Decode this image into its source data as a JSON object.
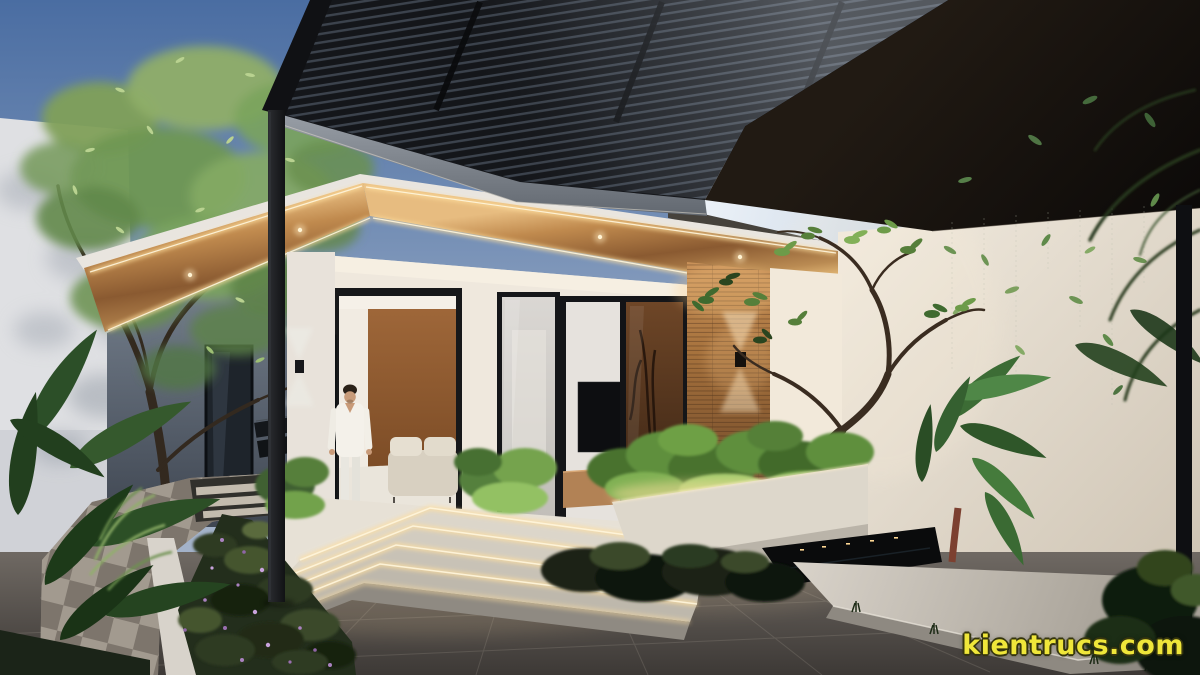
{
  "watermark": {
    "text": "kientrucs.com",
    "color": "#efe63a"
  },
  "scene": {
    "type": "exterior architectural 3D rendering",
    "subject": "modern single-storey house entrance at dusk with a black louvered pergola canopy, warm LED-lit wood soffit, glass sliding doors, stone walkway, planters and tropical plants",
    "person": "man in white shirt and trousers walking out of the open front door",
    "lighting": "warm LED strips along the soffit and stair nosings, up-down wall sconces, recessed downlights",
    "palette": {
      "sky": "#5a7dab",
      "pergola_slats": "#17191d",
      "upper_roof": "#110d0a",
      "wood_soffit": "#a9763f",
      "led_glow": "#ffdf9e",
      "white_walls": "#ece5da",
      "timber_feature_wall": "#a5713c",
      "interior_accent_wall": "#9a6132",
      "foliage_green": "#4e7a38",
      "hedge_flowers": "#9a6fb0",
      "pavement": "#4a4541",
      "stone_path": "#a49c91",
      "concrete_platform": "#c6c0b6"
    }
  }
}
